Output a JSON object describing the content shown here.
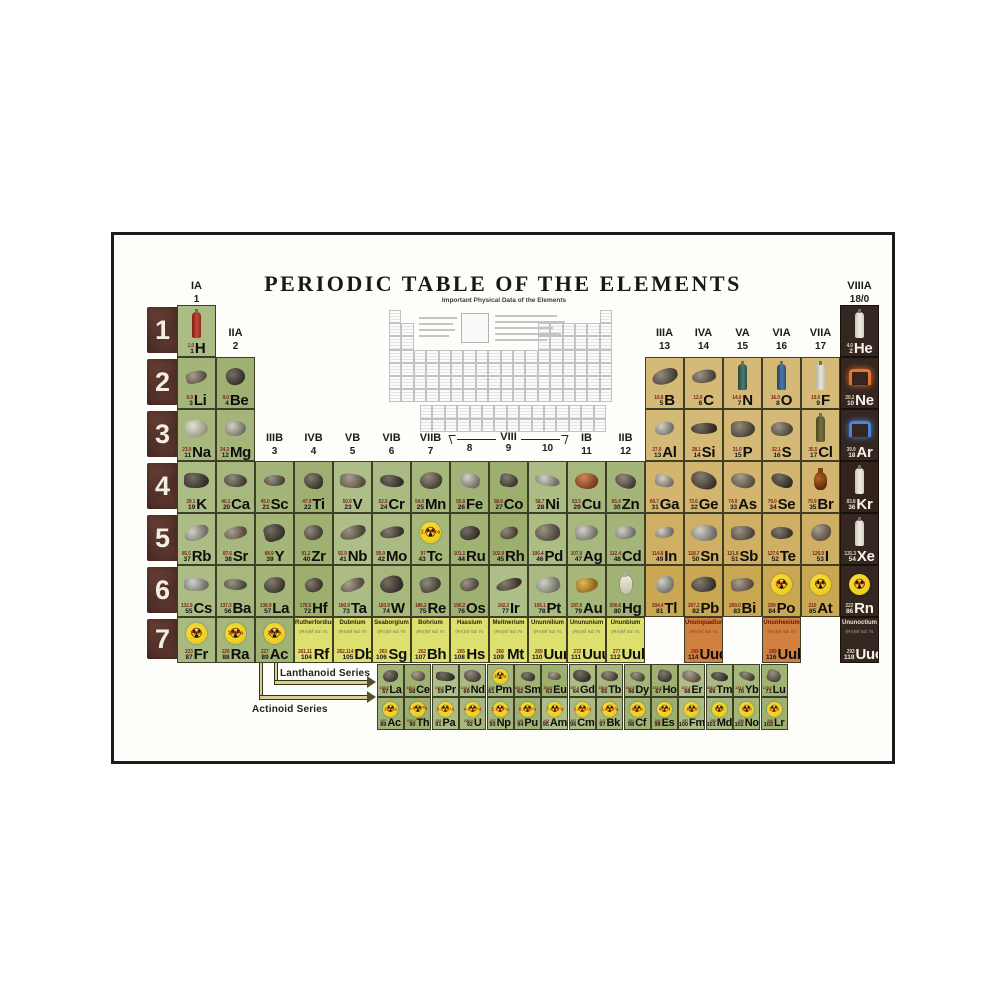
{
  "title": "PERIODIC TABLE OF THE ELEMENTS",
  "inset": {
    "caption": "Important Physical Data of the Elements"
  },
  "series": {
    "lanthanoid_label": "Lanthanoid Series",
    "actinoid_label": "Actinoid Series"
  },
  "periods": [
    "1",
    "2",
    "3",
    "4",
    "5",
    "6",
    "7"
  ],
  "group_headers": [
    {
      "roman": "IA",
      "num": "1",
      "col": 1,
      "band": "r1"
    },
    {
      "roman": "IIA",
      "num": "2",
      "col": 2,
      "band": "r2"
    },
    {
      "roman": "IIIB",
      "num": "3",
      "col": 3,
      "band": "r4"
    },
    {
      "roman": "IVB",
      "num": "4",
      "col": 4,
      "band": "r4"
    },
    {
      "roman": "VB",
      "num": "5",
      "col": 5,
      "band": "r4"
    },
    {
      "roman": "VIB",
      "num": "6",
      "col": 6,
      "band": "r4"
    },
    {
      "roman": "VIIB",
      "num": "7",
      "col": 7,
      "band": "r4"
    },
    {
      "roman": "VIII",
      "nums": [
        "8",
        "9",
        "10"
      ],
      "col": 8,
      "span": 3,
      "band": "r4",
      "bracket": true
    },
    {
      "roman": "IB",
      "num": "11",
      "col": 11,
      "band": "r4"
    },
    {
      "roman": "IIB",
      "num": "12",
      "col": 12,
      "band": "r4"
    },
    {
      "roman": "IIIA",
      "num": "13",
      "col": 13,
      "band": "r2"
    },
    {
      "roman": "IVA",
      "num": "14",
      "col": 14,
      "band": "r2"
    },
    {
      "roman": "VA",
      "num": "15",
      "col": 15,
      "band": "r2"
    },
    {
      "roman": "VIA",
      "num": "16",
      "col": 16,
      "band": "r2"
    },
    {
      "roman": "VIIA",
      "num": "17",
      "col": 17,
      "band": "r2"
    },
    {
      "roman": "VIIIA",
      "num": "18/0",
      "col": 18,
      "band": "r1"
    }
  ],
  "fine_print": "(Rn)5f 6d 7s",
  "colors": {
    "green": "#a9ba7c",
    "tan": "#dcc183",
    "orange": "#d2803f",
    "dark": "#2f211b",
    "ygreen": "#dde06e",
    "frame": "#1c1c1c",
    "trefoil": "#f0cf1d",
    "arrow": "#d8cd94"
  },
  "elements": [
    {
      "s": "H",
      "n": 1,
      "m": "1.0",
      "g": 1,
      "r": 1,
      "c": "green",
      "a": "c:red"
    },
    {
      "s": "He",
      "n": 2,
      "m": "4.0",
      "g": 18,
      "r": 1,
      "c": "dark",
      "a": "c:white"
    },
    {
      "s": "Li",
      "n": 3,
      "m": "6.9",
      "g": 1,
      "r": 2,
      "c": "green",
      "a": "k"
    },
    {
      "s": "Be",
      "n": 4,
      "m": "9.0",
      "g": 2,
      "r": 2,
      "c": "green",
      "a": "k"
    },
    {
      "s": "B",
      "n": 5,
      "m": "10.8",
      "g": 13,
      "r": 2,
      "c": "tan",
      "a": "k"
    },
    {
      "s": "C",
      "n": 6,
      "m": "12.0",
      "g": 14,
      "r": 2,
      "c": "tan",
      "a": "k"
    },
    {
      "s": "N",
      "n": 7,
      "m": "14.0",
      "g": 15,
      "r": 2,
      "c": "tan",
      "a": "c:green"
    },
    {
      "s": "O",
      "n": 8,
      "m": "16.0",
      "g": 16,
      "r": 2,
      "c": "tan",
      "a": "c:blue"
    },
    {
      "s": "F",
      "n": 9,
      "m": "19.0",
      "g": 17,
      "r": 2,
      "c": "tan",
      "a": "c:ivory"
    },
    {
      "s": "Ne",
      "n": 10,
      "m": "20.2",
      "g": 18,
      "r": 2,
      "c": "dark",
      "a": "n:#e8742c"
    },
    {
      "s": "Na",
      "n": 11,
      "m": "23.0",
      "g": 1,
      "r": 3,
      "c": "green",
      "a": "k:white"
    },
    {
      "s": "Mg",
      "n": 12,
      "m": "24.3",
      "g": 2,
      "r": 3,
      "c": "green",
      "a": "k:silver"
    },
    {
      "s": "Al",
      "n": 13,
      "m": "27.0",
      "g": 13,
      "r": 3,
      "c": "tan",
      "a": "k:silver"
    },
    {
      "s": "Si",
      "n": 14,
      "m": "28.1",
      "g": 14,
      "r": 3,
      "c": "tan",
      "a": "k"
    },
    {
      "s": "P",
      "n": 15,
      "m": "31.0",
      "g": 15,
      "r": 3,
      "c": "tan",
      "a": "k"
    },
    {
      "s": "S",
      "n": 16,
      "m": "32.1",
      "g": 16,
      "r": 3,
      "c": "tan",
      "a": "k"
    },
    {
      "s": "Cl",
      "n": 17,
      "m": "35.5",
      "g": 17,
      "r": 3,
      "c": "tan",
      "a": "c:olive"
    },
    {
      "s": "Ar",
      "n": 18,
      "m": "39.9",
      "g": 18,
      "r": 3,
      "c": "dark",
      "a": "n:#4a86d8"
    },
    {
      "s": "K",
      "n": 19,
      "m": "39.1",
      "g": 1,
      "r": 4,
      "c": "green",
      "a": "k"
    },
    {
      "s": "Ca",
      "n": 20,
      "m": "40.1",
      "g": 2,
      "r": 4,
      "c": "green",
      "a": "k"
    },
    {
      "s": "Sc",
      "n": 21,
      "m": "45.0",
      "g": 3,
      "r": 4,
      "c": "green",
      "a": "k"
    },
    {
      "s": "Ti",
      "n": 22,
      "m": "47.9",
      "g": 4,
      "r": 4,
      "c": "green",
      "a": "k"
    },
    {
      "s": "V",
      "n": 23,
      "m": "50.9",
      "g": 5,
      "r": 4,
      "c": "green",
      "a": "k"
    },
    {
      "s": "Cr",
      "n": 24,
      "m": "52.0",
      "g": 6,
      "r": 4,
      "c": "green",
      "a": "k"
    },
    {
      "s": "Mn",
      "n": 25,
      "m": "54.9",
      "g": 7,
      "r": 4,
      "c": "green",
      "a": "k"
    },
    {
      "s": "Fe",
      "n": 26,
      "m": "55.8",
      "g": 8,
      "r": 4,
      "c": "green",
      "a": "k:silver"
    },
    {
      "s": "Co",
      "n": 27,
      "m": "58.9",
      "g": 9,
      "r": 4,
      "c": "green",
      "a": "k"
    },
    {
      "s": "Ni",
      "n": 28,
      "m": "58.7",
      "g": 10,
      "r": 4,
      "c": "green",
      "a": "k:silver"
    },
    {
      "s": "Cu",
      "n": 29,
      "m": "63.5",
      "g": 11,
      "r": 4,
      "c": "green",
      "a": "k:copper"
    },
    {
      "s": "Zn",
      "n": 30,
      "m": "65.4",
      "g": 12,
      "r": 4,
      "c": "green",
      "a": "k"
    },
    {
      "s": "Ga",
      "n": 31,
      "m": "69.7",
      "g": 13,
      "r": 4,
      "c": "tan",
      "a": "k:silver"
    },
    {
      "s": "Ge",
      "n": 32,
      "m": "72.6",
      "g": 14,
      "r": 4,
      "c": "tan",
      "a": "k"
    },
    {
      "s": "As",
      "n": 33,
      "m": "74.9",
      "g": 15,
      "r": 4,
      "c": "tan",
      "a": "k"
    },
    {
      "s": "Se",
      "n": 34,
      "m": "79.0",
      "g": 16,
      "r": 4,
      "c": "tan",
      "a": "k"
    },
    {
      "s": "Br",
      "n": 35,
      "m": "79.9",
      "g": 17,
      "r": 4,
      "c": "tan",
      "a": "b"
    },
    {
      "s": "Kr",
      "n": 36,
      "m": "83.8",
      "g": 18,
      "r": 4,
      "c": "dark",
      "a": "c:white"
    },
    {
      "s": "Rb",
      "n": 37,
      "m": "85.5",
      "g": 1,
      "r": 5,
      "c": "green",
      "a": "k:silver"
    },
    {
      "s": "Sr",
      "n": 38,
      "m": "87.6",
      "g": 2,
      "r": 5,
      "c": "green",
      "a": "k"
    },
    {
      "s": "Y",
      "n": 39,
      "m": "88.9",
      "g": 3,
      "r": 5,
      "c": "green",
      "a": "k"
    },
    {
      "s": "Zr",
      "n": 40,
      "m": "91.2",
      "g": 4,
      "r": 5,
      "c": "green",
      "a": "k"
    },
    {
      "s": "Nb",
      "n": 41,
      "m": "92.9",
      "g": 5,
      "r": 5,
      "c": "green",
      "a": "k"
    },
    {
      "s": "Mo",
      "n": 42,
      "m": "95.9",
      "g": 6,
      "r": 5,
      "c": "green",
      "a": "k"
    },
    {
      "s": "Tc",
      "n": 43,
      "m": "97",
      "g": 7,
      "r": 5,
      "c": "green",
      "a": "t",
      "hl": "2.6·10⁶a"
    },
    {
      "s": "Ru",
      "n": 44,
      "m": "101.1",
      "g": 8,
      "r": 5,
      "c": "green",
      "a": "k"
    },
    {
      "s": "Rh",
      "n": 45,
      "m": "102.9",
      "g": 9,
      "r": 5,
      "c": "green",
      "a": "k"
    },
    {
      "s": "Pd",
      "n": 46,
      "m": "106.4",
      "g": 10,
      "r": 5,
      "c": "green",
      "a": "k"
    },
    {
      "s": "Ag",
      "n": 47,
      "m": "107.9",
      "g": 11,
      "r": 5,
      "c": "green",
      "a": "k:silver"
    },
    {
      "s": "Cd",
      "n": 48,
      "m": "112.4",
      "g": 12,
      "r": 5,
      "c": "green",
      "a": "k:silver"
    },
    {
      "s": "In",
      "n": 49,
      "m": "114.8",
      "g": 13,
      "r": 5,
      "c": "tan",
      "a": "k:silver"
    },
    {
      "s": "Sn",
      "n": 50,
      "m": "118.7",
      "g": 14,
      "r": 5,
      "c": "tan",
      "a": "k:silver"
    },
    {
      "s": "Sb",
      "n": 51,
      "m": "121.8",
      "g": 15,
      "r": 5,
      "c": "tan",
      "a": "k"
    },
    {
      "s": "Te",
      "n": 52,
      "m": "127.6",
      "g": 16,
      "r": 5,
      "c": "tan",
      "a": "k"
    },
    {
      "s": "I",
      "n": 53,
      "m": "126.9",
      "g": 17,
      "r": 5,
      "c": "tan",
      "a": "k"
    },
    {
      "s": "Xe",
      "n": 54,
      "m": "131.3",
      "g": 18,
      "r": 5,
      "c": "dark",
      "a": "c:white"
    },
    {
      "s": "Cs",
      "n": 55,
      "m": "132.9",
      "g": 1,
      "r": 6,
      "c": "green",
      "a": "k:silver"
    },
    {
      "s": "Ba",
      "n": 56,
      "m": "137.3",
      "g": 2,
      "r": 6,
      "c": "green",
      "a": "k"
    },
    {
      "s": "La",
      "n": 57,
      "m": "138.9",
      "g": 3,
      "r": 6,
      "c": "green",
      "a": "k"
    },
    {
      "s": "Hf",
      "n": 72,
      "m": "178.5",
      "g": 4,
      "r": 6,
      "c": "green",
      "a": "k"
    },
    {
      "s": "Ta",
      "n": 73,
      "m": "180.9",
      "g": 5,
      "r": 6,
      "c": "green",
      "a": "k"
    },
    {
      "s": "W",
      "n": 74,
      "m": "183.9",
      "g": 6,
      "r": 6,
      "c": "green",
      "a": "k"
    },
    {
      "s": "Re",
      "n": 75,
      "m": "186.2",
      "g": 7,
      "r": 6,
      "c": "green",
      "a": "k"
    },
    {
      "s": "Os",
      "n": 76,
      "m": "190.2",
      "g": 8,
      "r": 6,
      "c": "green",
      "a": "k"
    },
    {
      "s": "Ir",
      "n": 77,
      "m": "192.2",
      "g": 9,
      "r": 6,
      "c": "green",
      "a": "k"
    },
    {
      "s": "Pt",
      "n": 78,
      "m": "195.1",
      "g": 10,
      "r": 6,
      "c": "green",
      "a": "k:silver"
    },
    {
      "s": "Au",
      "n": 79,
      "m": "197.0",
      "g": 11,
      "r": 6,
      "c": "green",
      "a": "k:gold"
    },
    {
      "s": "Hg",
      "n": 80,
      "m": "200.6",
      "g": 12,
      "r": 6,
      "c": "green",
      "a": "f"
    },
    {
      "s": "Tl",
      "n": 81,
      "m": "204.4",
      "g": 13,
      "r": 6,
      "c": "tan",
      "a": "k:silver"
    },
    {
      "s": "Pb",
      "n": 82,
      "m": "207.2",
      "g": 14,
      "r": 6,
      "c": "tan",
      "a": "k"
    },
    {
      "s": "Bi",
      "n": 83,
      "m": "209.0",
      "g": 15,
      "r": 6,
      "c": "tan",
      "a": "k"
    },
    {
      "s": "Po",
      "n": 84,
      "m": "209",
      "g": 16,
      "r": 6,
      "c": "tan",
      "a": "t",
      "hl": "102 a"
    },
    {
      "s": "At",
      "n": 85,
      "m": "210",
      "g": 17,
      "r": 6,
      "c": "tan",
      "a": "t",
      "hl": "8.3 h"
    },
    {
      "s": "Rn",
      "n": 86,
      "m": "222",
      "g": 18,
      "r": 6,
      "c": "dark",
      "a": "t",
      "hl": "3.8 d"
    },
    {
      "s": "Fr",
      "n": 87,
      "m": "223",
      "g": 1,
      "r": 7,
      "c": "green",
      "a": "t",
      "hl": "22 m"
    },
    {
      "s": "Ra",
      "n": 88,
      "m": "226",
      "g": 2,
      "r": 7,
      "c": "green",
      "a": "t",
      "hl": "1600 a"
    },
    {
      "s": "Ac",
      "n": 89,
      "m": "227",
      "g": 3,
      "r": 7,
      "c": "green",
      "a": "t",
      "hl": "21.8 a"
    },
    {
      "s": "Rf",
      "n": 104,
      "m": "261.11",
      "g": 4,
      "r": 7,
      "c": "ygreen",
      "name": "Rutherfordium"
    },
    {
      "s": "Db",
      "n": 105,
      "m": "262.114",
      "g": 5,
      "r": 7,
      "c": "ygreen",
      "name": "Dubnium"
    },
    {
      "s": "Sg",
      "n": 106,
      "m": "263",
      "g": 6,
      "r": 7,
      "c": "ygreen",
      "name": "Seaborgium"
    },
    {
      "s": "Bh",
      "n": 107,
      "m": "262",
      "g": 7,
      "r": 7,
      "c": "ygreen",
      "name": "Bohrium"
    },
    {
      "s": "Hs",
      "n": 108,
      "m": "265",
      "g": 8,
      "r": 7,
      "c": "ygreen",
      "name": "Hassium"
    },
    {
      "s": "Mt",
      "n": 109,
      "m": "266",
      "g": 9,
      "r": 7,
      "c": "ygreen",
      "name": "Meitnerium"
    },
    {
      "s": "Uun",
      "n": 110,
      "m": "269",
      "g": 10,
      "r": 7,
      "c": "ygreen",
      "name": "Ununnilium"
    },
    {
      "s": "Uuu",
      "n": 111,
      "m": "272",
      "g": 11,
      "r": 7,
      "c": "ygreen",
      "name": "Unununium"
    },
    {
      "s": "Uub",
      "n": 112,
      "m": "277",
      "g": 12,
      "r": 7,
      "c": "ygreen",
      "name": "Ununbium"
    },
    {
      "s": "",
      "n": 113,
      "m": "",
      "g": 13,
      "r": 7,
      "c": "blank"
    },
    {
      "s": "Uuq",
      "n": 114,
      "m": "289",
      "g": 14,
      "r": 7,
      "c": "orange",
      "name": "Ununquadium"
    },
    {
      "s": "",
      "n": 115,
      "m": "",
      "g": 15,
      "r": 7,
      "c": "blank"
    },
    {
      "s": "Uuh",
      "n": 116,
      "m": "289",
      "g": 16,
      "r": 7,
      "c": "orange",
      "name": "Ununhexium"
    },
    {
      "s": "",
      "n": 117,
      "m": "",
      "g": 17,
      "r": 7,
      "c": "blank"
    },
    {
      "s": "Uuo",
      "n": 118,
      "m": "293",
      "g": 18,
      "r": 7,
      "c": "dark",
      "name": "Ununoctium"
    }
  ],
  "lanthanoids": [
    {
      "s": "La",
      "n": 57,
      "m": "138.9",
      "a": "k"
    },
    {
      "s": "Ce",
      "n": 58,
      "m": "140.1",
      "a": "k"
    },
    {
      "s": "Pr",
      "n": 59,
      "m": "140.9",
      "a": "k"
    },
    {
      "s": "Nd",
      "n": 60,
      "m": "144.2",
      "a": "k"
    },
    {
      "s": "Pm",
      "n": 61,
      "m": "145",
      "a": "t",
      "hl": "17.7 a"
    },
    {
      "s": "Sm",
      "n": 62,
      "m": "150.4",
      "a": "k"
    },
    {
      "s": "Eu",
      "n": 63,
      "m": "152.0",
      "a": "k"
    },
    {
      "s": "Gd",
      "n": 64,
      "m": "157.3",
      "a": "k"
    },
    {
      "s": "Tb",
      "n": 65,
      "m": "158.9",
      "a": "k"
    },
    {
      "s": "Dy",
      "n": 66,
      "m": "162.5",
      "a": "k"
    },
    {
      "s": "Ho",
      "n": 67,
      "m": "164.9",
      "a": "k"
    },
    {
      "s": "Er",
      "n": 68,
      "m": "167.3",
      "a": "k"
    },
    {
      "s": "Tm",
      "n": 69,
      "m": "168.9",
      "a": "k"
    },
    {
      "s": "Yb",
      "n": 70,
      "m": "173.0",
      "a": "k"
    },
    {
      "s": "Lu",
      "n": 71,
      "m": "175.0",
      "a": "k"
    }
  ],
  "actinoids": [
    {
      "s": "Ac",
      "n": 89,
      "m": "227",
      "a": "t",
      "hl": "21.8 a"
    },
    {
      "s": "Th",
      "n": 90,
      "m": "232.0",
      "a": "t",
      "hl": "1.4·10¹⁰a"
    },
    {
      "s": "Pa",
      "n": 91,
      "m": "231",
      "a": "t",
      "hl": "3.3·10⁴a"
    },
    {
      "s": "U",
      "n": 92,
      "m": "238.0",
      "a": "t",
      "hl": "4.5·10⁹a"
    },
    {
      "s": "Np",
      "n": 93,
      "m": "237",
      "a": "t",
      "hl": "2.1·10⁶a"
    },
    {
      "s": "Pu",
      "n": 94,
      "m": "244",
      "a": "t",
      "hl": "8.0·10⁷a"
    },
    {
      "s": "Am",
      "n": 95,
      "m": "243",
      "a": "t",
      "hl": "7.4·10³a"
    },
    {
      "s": "Cm",
      "n": 96,
      "m": "247",
      "a": "t",
      "hl": "1.6·10⁷a"
    },
    {
      "s": "Bk",
      "n": 97,
      "m": "247",
      "a": "t",
      "hl": "1.4·10³a"
    },
    {
      "s": "Cf",
      "n": 98,
      "m": "251",
      "a": "t",
      "hl": "900 a"
    },
    {
      "s": "Es",
      "n": 99,
      "m": "252",
      "a": "t",
      "hl": "472 d"
    },
    {
      "s": "Fm",
      "n": 100,
      "m": "257",
      "a": "t",
      "hl": "100 d"
    },
    {
      "s": "Md",
      "n": 101,
      "m": "258",
      "a": "t",
      "hl": "52 d"
    },
    {
      "s": "No",
      "n": 102,
      "m": "259",
      "a": "t",
      "hl": "58 m"
    },
    {
      "s": "Lr",
      "n": 103,
      "m": "260",
      "a": "t",
      "hl": "3.6 h"
    }
  ]
}
